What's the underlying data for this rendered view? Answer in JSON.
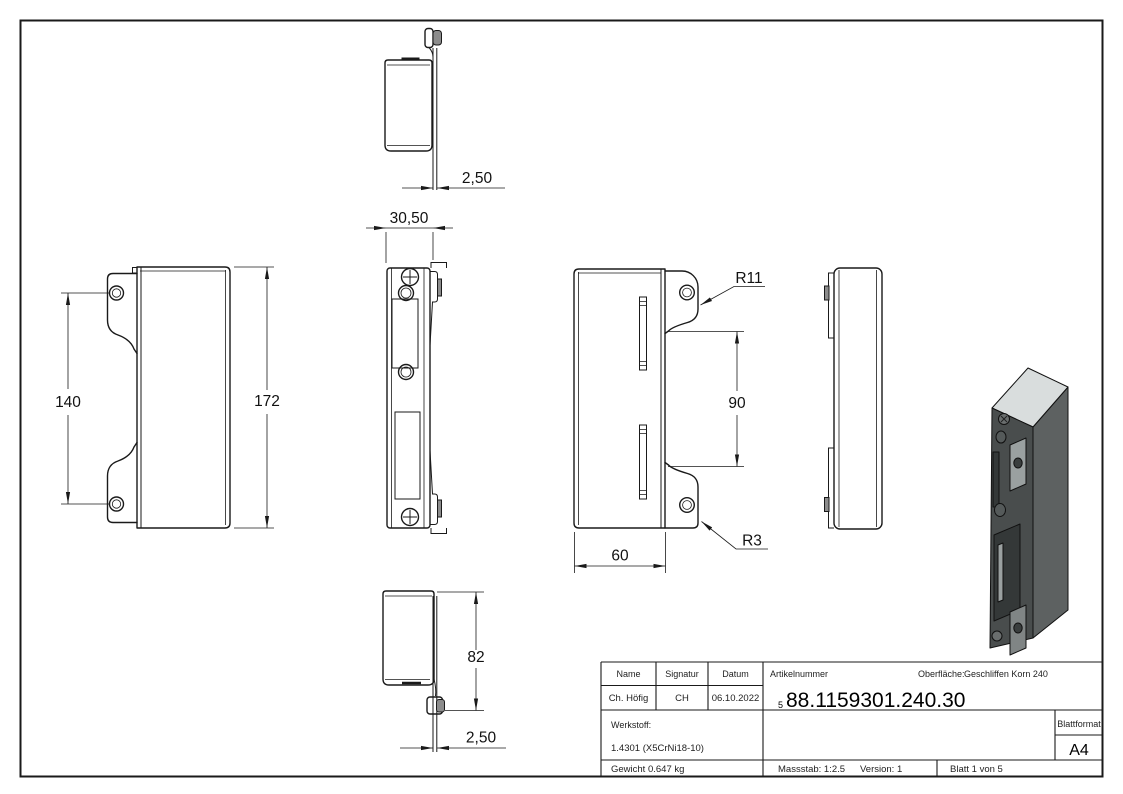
{
  "dimensions": {
    "top_flange": "2,50",
    "side_width": "30,50",
    "hole_spacing": "140",
    "total_height": "172",
    "tab_radius": "R11",
    "tab_spacing": "90",
    "corner_radius": "R3",
    "body_width": "60",
    "depth": "82",
    "bottom_flange": "2,50"
  },
  "title_block": {
    "headers": {
      "name": "Name",
      "signatur": "Signatur",
      "datum": "Datum",
      "artikelnummer": "Artikelnummer",
      "blattformat": "Blattformat"
    },
    "values": {
      "name": "Ch. Höfig",
      "signatur": "CH",
      "datum": "06.10.2022",
      "artikelnummer_prefix": "5",
      "artikelnummer": "88.1159301.240.30",
      "blattformat": "A4"
    },
    "oberflaeche_label": "Oberfläche:",
    "oberflaeche_value": "Geschliffen Korn 240",
    "werkstoff_label": "Werkstoff:",
    "werkstoff_value": "1.4301 (X5CrNi18-10)",
    "gewicht": "Gewicht 0.647 kg",
    "massstab": "Massstab: 1:2.5",
    "version": "Version: 1",
    "blatt": "Blatt 1 von 5"
  },
  "colors": {
    "line": "#1a1a1a",
    "iso_top": "#d9dddd",
    "iso_side": "#5d6161",
    "iso_front": "#494d4d",
    "iso_detail": "#9aa0a0",
    "iso_tab": "#808585",
    "iso_dark": "#343838"
  }
}
